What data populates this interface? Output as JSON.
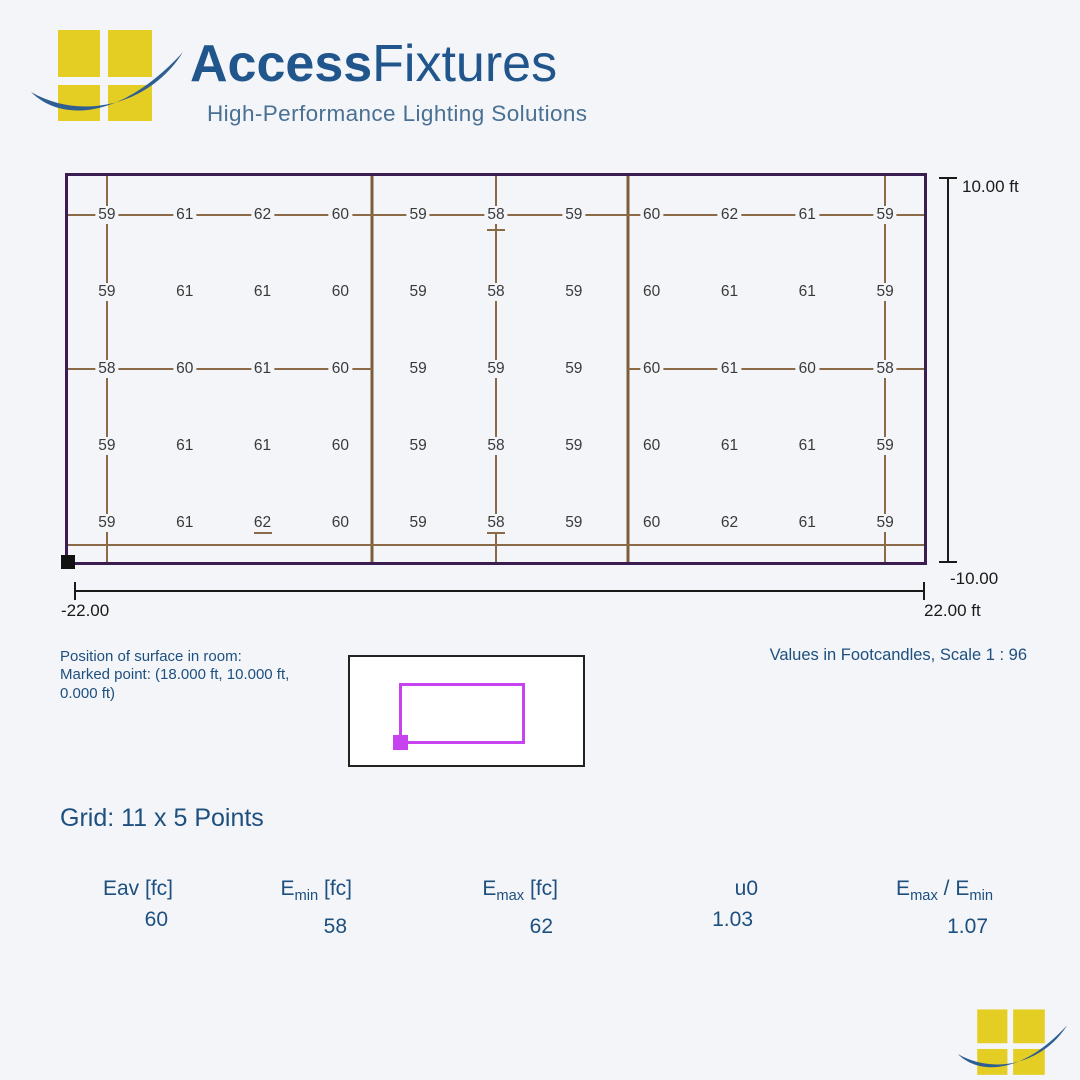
{
  "header": {
    "brand_bold": "Access",
    "brand_regular": "Fixtures",
    "tagline": "High-Performance Lighting Solutions"
  },
  "chart_data": {
    "type": "heatmap",
    "title": "Grid: 11 x 5 Points",
    "unit": "Footcandles",
    "cols_x_ft": [
      -20,
      -16,
      -12,
      -8,
      -4,
      0,
      4,
      8,
      12,
      16,
      20
    ],
    "rows_y_ft": [
      8,
      4,
      0,
      -4,
      -8
    ],
    "values": [
      [
        59,
        61,
        62,
        60,
        59,
        58,
        59,
        60,
        62,
        61,
        59
      ],
      [
        59,
        61,
        61,
        60,
        59,
        58,
        59,
        60,
        61,
        61,
        59
      ],
      [
        58,
        60,
        61,
        60,
        59,
        59,
        59,
        60,
        61,
        60,
        58
      ],
      [
        59,
        61,
        61,
        60,
        59,
        58,
        59,
        60,
        61,
        61,
        59
      ],
      [
        59,
        61,
        62,
        60,
        59,
        58,
        59,
        60,
        62,
        61,
        59
      ]
    ],
    "x_range_ft": [
      -22,
      22
    ],
    "y_range_ft": [
      -10,
      10
    ],
    "axis_labels": {
      "y_top": "10.00 ft",
      "y_bottom": "-10.00",
      "x_left": "-22.00",
      "x_right": "22.00 ft"
    }
  },
  "surface_info": {
    "text": "Position of surface in room:\nMarked point: (18.000 ft, 10.000 ft,\n0.000 ft)"
  },
  "values_note": "Values in Footcandles, Scale 1 : 96",
  "grid_title": "Grid: 11 x 5 Points",
  "stats": [
    {
      "header": [
        {
          "t": "Eav"
        },
        {
          "t": " [fc]"
        }
      ],
      "value": "60"
    },
    {
      "header": [
        {
          "t": "E"
        },
        {
          "t": "min",
          "sub": true
        },
        {
          "t": " [fc]"
        }
      ],
      "value": "58"
    },
    {
      "header": [
        {
          "t": "E"
        },
        {
          "t": "max",
          "sub": true
        },
        {
          "t": " [fc]"
        }
      ],
      "value": "62"
    },
    {
      "header": [
        {
          "t": "u0"
        }
      ],
      "value": "1.03"
    },
    {
      "header": [
        {
          "t": "E"
        },
        {
          "t": "max",
          "sub": true
        },
        {
          "t": " / E"
        },
        {
          "t": "min",
          "sub": true
        }
      ],
      "value": "1.07"
    }
  ],
  "colors": {
    "background": "#f3f5f8",
    "accent_blue": "#1d4f7f",
    "room_border_purple": "#3b1d52",
    "grid_line_brown": "#8b6b47",
    "surface_magenta": "#c643ef",
    "logo_yellow": "#e5ce24",
    "logo_swoosh_blue": "#2e5e92"
  }
}
